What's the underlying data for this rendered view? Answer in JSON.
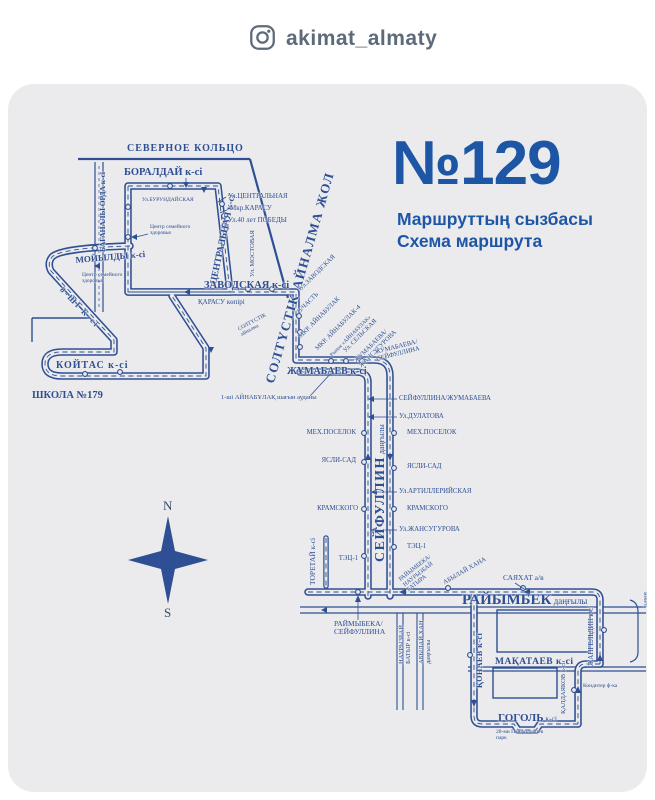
{
  "header": {
    "instagram_handle": "akimat_almaty"
  },
  "title": {
    "route_number": "№129",
    "subtitle_line1": "Маршруттың сызбасы",
    "subtitle_line2": "Схема маршрута"
  },
  "compass": {
    "north": "N",
    "south": "S"
  },
  "colors": {
    "accent_blue": "#1d56a5",
    "map_blue": "#2e4f93",
    "card_bg": "#ebebed",
    "header_gray": "#5d6a7a"
  },
  "map": {
    "labels": {
      "severnoe_koltso": "СЕВЕРНОЕ КОЛЬЦО",
      "boraldai": "БОРАЛДАЙ к-сі",
      "baganaly_orda": "БАГАНАЛЫ ОРДА к-сі",
      "centralnaya_street": "ЦЕНТРАЛЬНАЯ к-сі",
      "ul_centralnaya": "Ул.ЦЕНТРАЛЬНАЯ",
      "mkr_karasu": "Мкр.КАРАСУ",
      "ul_40_let_pobedy": "Ул.40 лет ПОБЕДЫ",
      "ul_burundaiskaya": "Ул.БУРУНДАЙСКАЯ",
      "health_center_1": "Центр семейного\nздоровья",
      "ul_mostovaya": "Ул. МОСТОВАЯ",
      "moiyldy": "МОЙЫЛДЫ к-сі",
      "health_center_2": "Центр семейного\nздоровья",
      "street_8": "8-ШІ К-сі",
      "koitas": "КОЙТАС к-сі",
      "shkola_179": "ШКОЛА №179",
      "zavodskaya": "ЗАВОДСКАЯ к-сі",
      "karasu_kopiri": "ҚАРАСУ көпірі",
      "soltustik_small": "СОЛТҮСТІК\nайналма",
      "soltustik_ainalma_zhol": "СОЛТҮСТІК АЙНАЛМА ЖОЛ",
      "diag_ul_zavodskaya": "Ул.ЗАВОДСКАЯ",
      "diag_v_chast": "В/ЧАСТЬ",
      "diag_mkr_ainabulak": "МКР. АЙНАБУЛАК",
      "diag_mkr_ainabulak_4": "МКР. АЙНАБУЛАК-4",
      "diag_rynok_ainabulak": "Рынок «АЙНАБУЛАК»",
      "diag_ul_selskaya": "Ул. СЕЛЬСКАЯ",
      "diag_zhumabaeva_zhansugurova": "ЖУМАБАЕВА/\nЖАНСУГУРОВА",
      "diag_zhumabaeva_seifullina": "ЖУМАБАЕВА/\nСЕЙФУЛЛИНА",
      "zhumabaev": "ЖҰМАБАЕВ к-сі",
      "ainabulak_1": "1-ші АЙНАБҰЛАҚ шағын ауданы",
      "seifullin_name": "СЕЙФУЛЛИН",
      "seifullin_suffix": " даңғылы",
      "stop_seifullina_zhumabaeva": "СЕЙФУЛЛИНА/ЖУМАБАЕВА",
      "stop_ul_dulatova": "Ул.ДУЛАТОВА",
      "mekhposelok_right": "МЕХ.ПОСЕЛОК",
      "mekhposelok_left": "МЕХ.ПОСЕЛОК",
      "yasli_sad_right": "ЯСЛИ-САД",
      "yasli_sad_left": "ЯСЛИ-САД",
      "stop_ul_artilleriyskaya": "Ул.АРТИЛЛЕРИЙСКАЯ",
      "kramskogo_right": "КРАМСКОГО",
      "kramskogo_left": "КРАМСКОГО",
      "stop_ul_zhansugurova": "Ул.ЖАНСУГУРОВА",
      "tec_1_right": "ТЭЦ-1",
      "tec_1_left": "ТЭЦ-1",
      "toretai": "ТОРЕТАЙ к-сі",
      "diag_raiymbeka_nauryzbai": "РАЙЫМБЕКА/\nНАУРЫЗБАЙ\nБАТЫРА",
      "diag_abylai_khana": "АБЫЛАЙ ХАНА",
      "sayakhat": "САЯХАТ а/в",
      "raiymbek_name": "РАЙЫМБЕК",
      "raiymbek_suffix": " даңғылы",
      "stop_raimybeka_seifullina": "РАЙМЫБЕКА/\nСЕЙФУЛЛИНА",
      "nauryzbai_batyr": "НАУРЫЗБАЙ\nБАТЫР к-сі",
      "abylai_khan": "АБЫЛАЙ ХАН\nдаңғылы",
      "konaev": "ҚОНАЕВ к-сі",
      "zhangeldin": "ЖАНГЕЛЬДИН к-сі",
      "mechet": "мечеть",
      "makataev": "МАҚАТАЕВ к-сі",
      "kaldayakov": "ҚАЛДАЯКОВ к-сі",
      "konditer_fabrika": "Кондитер ф-ка",
      "gogol_name": "ГОГОЛЬ",
      "gogol_suffix": " к-сі",
      "park_28": "28-ми Панфиловцев\nпарк"
    }
  }
}
